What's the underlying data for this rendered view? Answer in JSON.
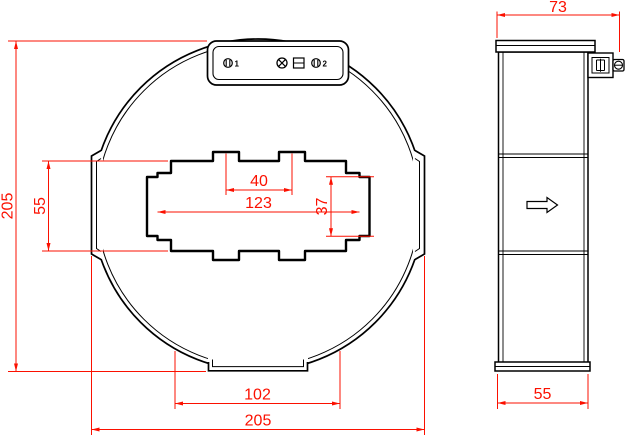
{
  "drawing": {
    "front": {
      "overall_height": "205",
      "window_height": "55",
      "bump_spacing": "40",
      "window_width": "123",
      "tab_height": "37",
      "foot_width": "102",
      "overall_width": "205"
    },
    "side": {
      "depth_top": "73",
      "depth_bottom": "55"
    },
    "terminals": {
      "t1": "1",
      "t2": "2"
    },
    "colors": {
      "dimension": "#FB1000",
      "outline": "#000000",
      "background": "#FFFFFF"
    }
  }
}
